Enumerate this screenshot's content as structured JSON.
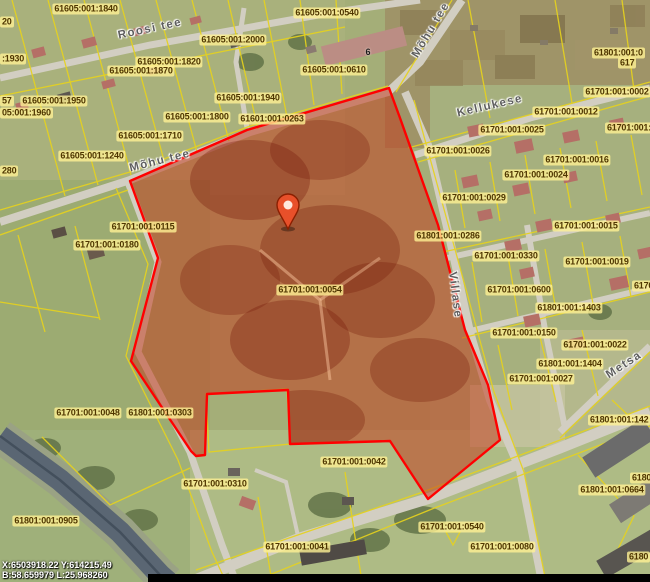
{
  "map": {
    "selected_parcel_code": "61701:001:0054",
    "pin": {
      "x": 288,
      "y": 229
    },
    "coordinates": {
      "line1": "X:6503918.22 Y:614215.49",
      "line2": "B:58.659979 L:25.968260"
    },
    "house_numbers": [
      {
        "text": "6",
        "x": 368,
        "y": 52
      }
    ],
    "street_labels": [
      {
        "text": "Roosi tee",
        "x": 150,
        "y": 29,
        "rotate": -12
      },
      {
        "text": "Mõhu tee",
        "x": 160,
        "y": 161,
        "rotate": -14
      },
      {
        "text": "Mõhu tee",
        "x": 431,
        "y": 30,
        "rotate": -59
      },
      {
        "text": "Kellukese",
        "x": 490,
        "y": 106,
        "rotate": -13
      },
      {
        "text": "Villase",
        "x": 455,
        "y": 295,
        "rotate": 83
      },
      {
        "text": "Metsa",
        "x": 624,
        "y": 365,
        "rotate": -33
      }
    ],
    "parcel_labels": [
      {
        "text": "61605:001:1840",
        "x": 86,
        "y": 9
      },
      {
        "text": "61605:001:0540",
        "x": 327,
        "y": 13
      },
      {
        "text": "61605:001:2000",
        "x": 233,
        "y": 40
      },
      {
        "text": "61605:001:0610",
        "x": 334,
        "y": 70
      },
      {
        "text": "61605:001:1820",
        "x": 169,
        "y": 62
      },
      {
        "text": "61605:001:1870",
        "x": 141,
        "y": 71
      },
      {
        "text": "61605:001:1940",
        "x": 248,
        "y": 98
      },
      {
        "text": "61601:001:0263",
        "x": 272,
        "y": 119
      },
      {
        "text": "61605:001:1800",
        "x": 197,
        "y": 117
      },
      {
        "text": "61605:001:1710",
        "x": 150,
        "y": 136
      },
      {
        "text": "61605:001:1240",
        "x": 92,
        "y": 156
      },
      {
        "text": "61605:001:1950",
        "x": 54,
        "y": 101
      },
      {
        "text": "05:001:1960",
        "x": 0,
        "y": 113,
        "align": "left"
      },
      {
        "text": "20",
        "x": 0,
        "y": 22,
        "align": "left"
      },
      {
        "text": ":1930",
        "x": 0,
        "y": 59,
        "align": "left"
      },
      {
        "text": "57",
        "x": 0,
        "y": 101,
        "align": "left"
      },
      {
        "text": "280",
        "x": 0,
        "y": 171,
        "align": "left"
      },
      {
        "text": "61701:001:0115",
        "x": 143,
        "y": 227
      },
      {
        "text": "61701:001:0180",
        "x": 107,
        "y": 245
      },
      {
        "text": "61701:001:0054",
        "x": 310,
        "y": 290
      },
      {
        "text": "61701:001:0048",
        "x": 88,
        "y": 413
      },
      {
        "text": "61801:001:0303",
        "x": 160,
        "y": 413
      },
      {
        "text": "61701:001:0310",
        "x": 215,
        "y": 484
      },
      {
        "text": "61701:001:0042",
        "x": 354,
        "y": 462
      },
      {
        "text": "61701:001:0041",
        "x": 297,
        "y": 547
      },
      {
        "text": "61701:001:0540",
        "x": 452,
        "y": 527
      },
      {
        "text": "61701:001:0080",
        "x": 502,
        "y": 547
      },
      {
        "text": "61701:001:0025",
        "x": 512,
        "y": 130
      },
      {
        "text": "61701:001:0012",
        "x": 566,
        "y": 112
      },
      {
        "text": "61701:001:0002",
        "x": 617,
        "y": 92
      },
      {
        "text": "617",
        "x": 618,
        "y": 63,
        "align": "left"
      },
      {
        "text": "61801:001:0",
        "x": 592,
        "y": 53,
        "align": "left"
      },
      {
        "text": "61701:001:0026",
        "x": 458,
        "y": 151
      },
      {
        "text": "61701:001:0016",
        "x": 577,
        "y": 160
      },
      {
        "text": "61701:001:0024",
        "x": 536,
        "y": 175
      },
      {
        "text": "61701:001:0029",
        "x": 474,
        "y": 198
      },
      {
        "text": "61701:001:0015",
        "x": 586,
        "y": 226
      },
      {
        "text": "61701:001:",
        "x": 605,
        "y": 128,
        "align": "left"
      },
      {
        "text": "6170",
        "x": 632,
        "y": 286,
        "align": "left"
      },
      {
        "text": "61701:001:0330",
        "x": 506,
        "y": 256
      },
      {
        "text": "61701:001:0019",
        "x": 597,
        "y": 262
      },
      {
        "text": "61701:001:0600",
        "x": 519,
        "y": 290
      },
      {
        "text": "61801:001:1403",
        "x": 569,
        "y": 308
      },
      {
        "text": "61701:001:0150",
        "x": 524,
        "y": 333
      },
      {
        "text": "61701:001:0027",
        "x": 541,
        "y": 379
      },
      {
        "text": "61701:001:0022",
        "x": 595,
        "y": 345
      },
      {
        "text": "61801:001:1404",
        "x": 570,
        "y": 364
      },
      {
        "text": "61801:001:0286",
        "x": 448,
        "y": 236
      },
      {
        "text": "61801:001:142",
        "x": 588,
        "y": 420,
        "align": "left"
      },
      {
        "text": "61801:001:0664",
        "x": 612,
        "y": 490
      },
      {
        "text": "6180",
        "x": 630,
        "y": 478,
        "align": "left"
      },
      {
        "text": "6180",
        "x": 627,
        "y": 557,
        "align": "left"
      },
      {
        "text": "61801:001:0905",
        "x": 46,
        "y": 521
      }
    ],
    "colors": {
      "selection_outline": "#ff0000",
      "selection_fill": "rgba(196,58,28,0.5)",
      "cadastral_line": "#e6d21e",
      "label_background": "rgba(255,241,148,0.8)",
      "label_text": "#4f3600",
      "pin": "#e8502a",
      "water": "#5a6673",
      "road": "#d2cec2"
    }
  }
}
